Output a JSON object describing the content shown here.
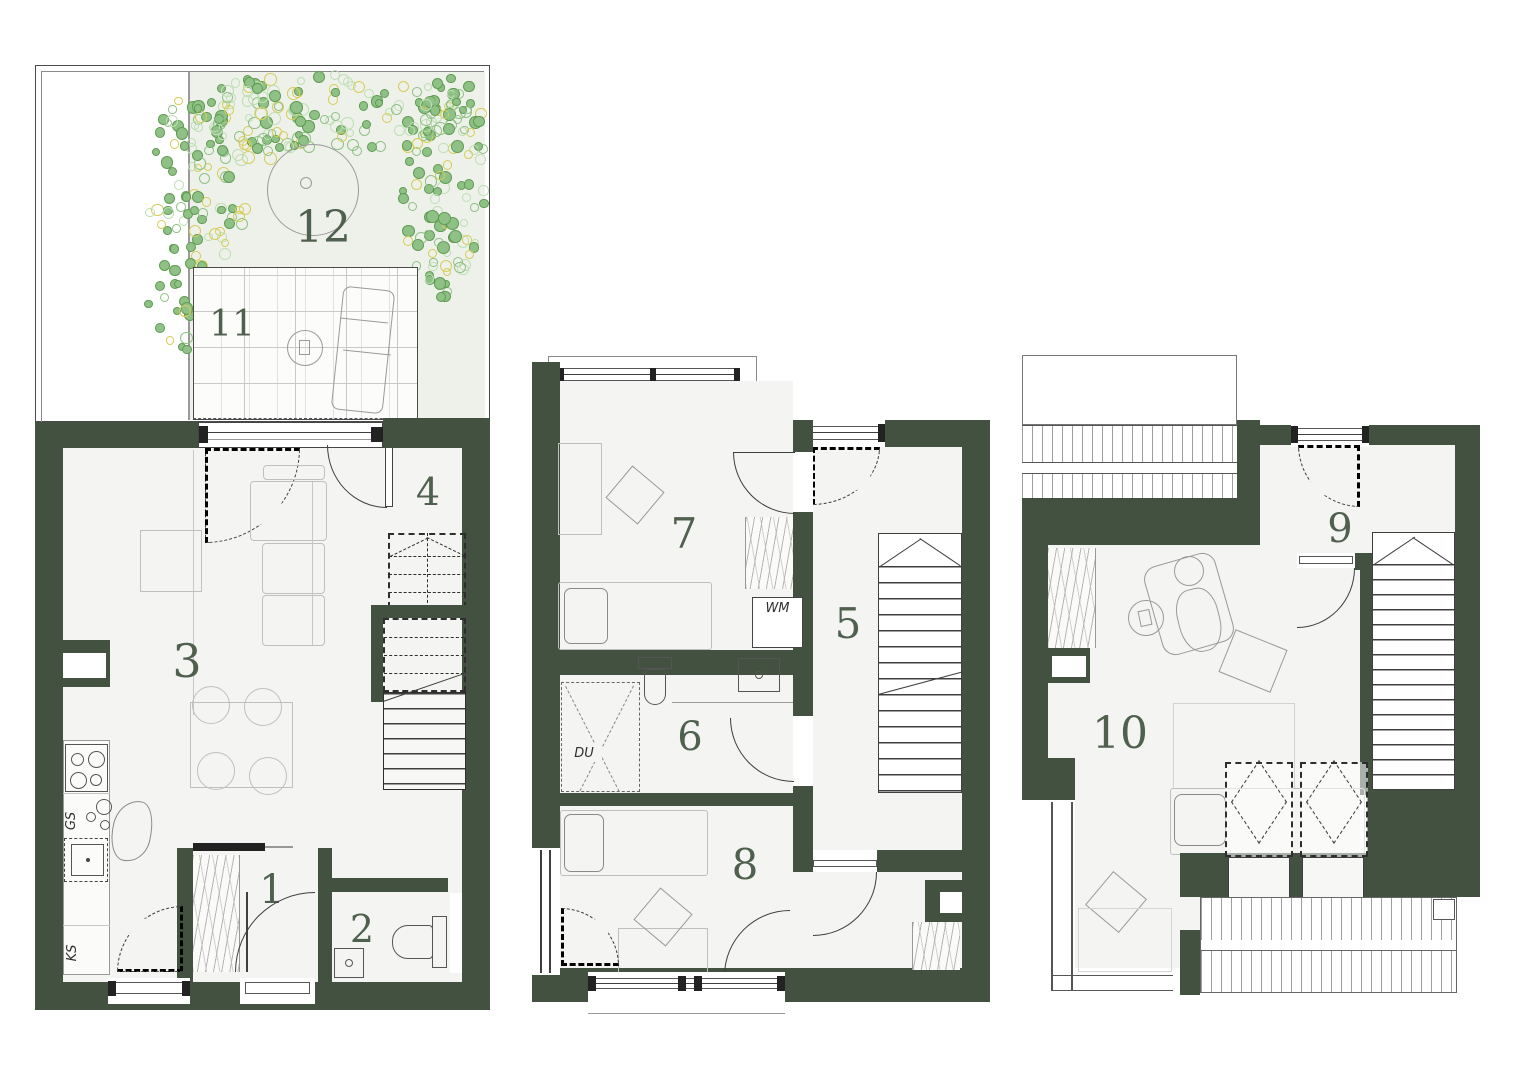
{
  "palette": {
    "wall_green": "#425140",
    "room_fill": "#f4f4f2",
    "garden_fill": "#eef0ea",
    "label_green": "#50604f",
    "plan_line": "#3f3f3f",
    "furniture_line": "#c2c2c2",
    "dot_green_fill": "#8fc186",
    "dot_green_stroke": "#5f9b52",
    "dot_yellow_stroke": "#d6cd58",
    "dot_pale_stroke": "#bedfb4"
  },
  "floors": [
    {
      "id": "ground-floor",
      "room_numbers": [
        "1",
        "2",
        "3",
        "4",
        "11",
        "12"
      ]
    },
    {
      "id": "first-floor",
      "room_numbers": [
        "5",
        "6",
        "7",
        "8"
      ]
    },
    {
      "id": "second-floor",
      "room_numbers": [
        "9",
        "10"
      ]
    }
  ],
  "room_labels": {
    "r1": "1",
    "r2": "2",
    "r3": "3",
    "r4": "4",
    "r5": "5",
    "r6": "6",
    "r7": "7",
    "r8": "8",
    "r9": "9",
    "r10": "10",
    "r11": "11",
    "r12": "12"
  },
  "fixture_labels": {
    "washing_machine": "WM",
    "shower": "DU",
    "dishwasher": "GS",
    "fridge": "KS"
  }
}
